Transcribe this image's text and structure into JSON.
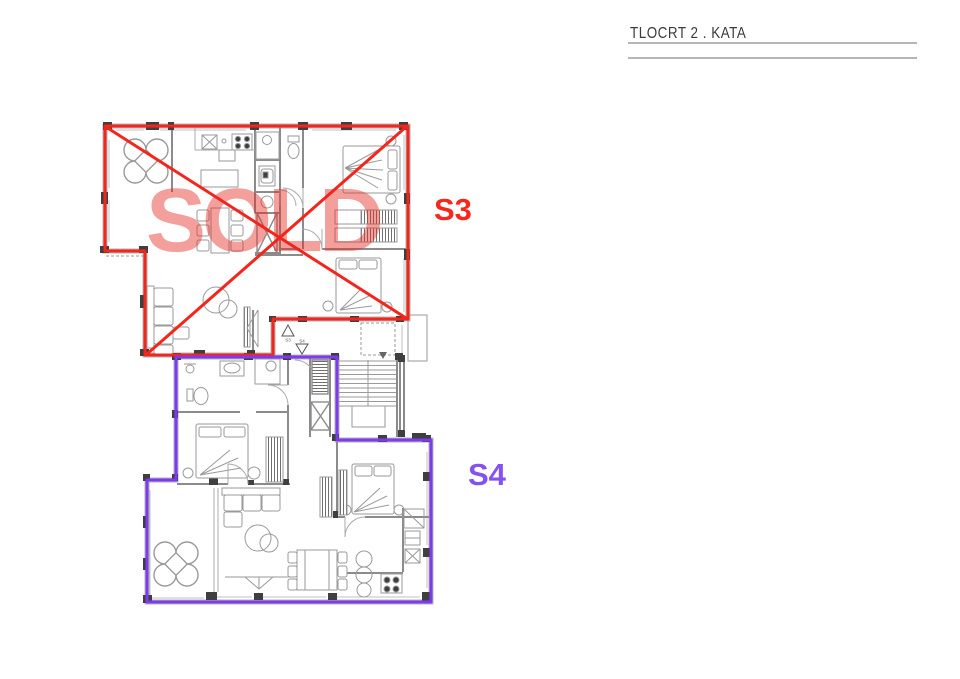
{
  "title_block": {
    "title": "TLOCRT 2 . KATA"
  },
  "overlays": {
    "sold_text": "SOLD"
  },
  "apartments": {
    "s3": {
      "label": "S3",
      "status": "SOLD",
      "outline_color": "#f5251c"
    },
    "s4": {
      "label": "S4",
      "status": "",
      "outline_color": "#7d3af0"
    }
  },
  "entry_markers": {
    "s3": "S3",
    "s4": "S4"
  },
  "colors": {
    "red_outline": "#f5251c",
    "purple_outline": "#7d3af0",
    "sold_text": "rgba(228,42,36,0.45)",
    "plan_line": "#9a9a9a",
    "wall_dark": "#3f3f3f"
  }
}
